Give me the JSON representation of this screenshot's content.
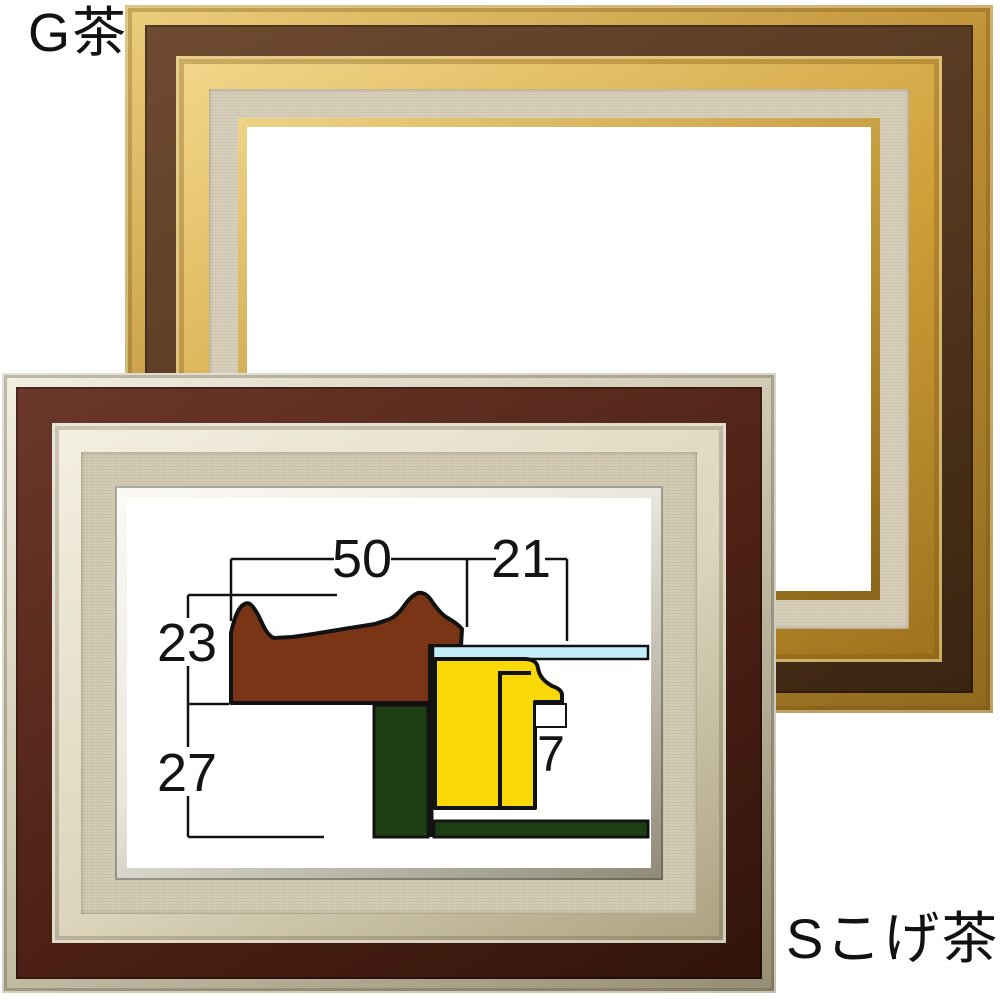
{
  "frames": {
    "gold": {
      "label": "G茶"
    },
    "silver": {
      "label": "Sこげ茶"
    }
  },
  "diagram": {
    "type": "frame-cross-section",
    "dimension_labels": {
      "molding_width": "50",
      "rabbet_width": "21",
      "molding_height": "23",
      "lower_depth": "27",
      "lip_depth": "7"
    }
  },
  "colors": {
    "gold-outer": "#bf9136",
    "gold-brown": "#54371f",
    "gold-mid": "#cf9f38",
    "gold-linen": "#d9d0bb",
    "gold-lip": "#c39a3b",
    "silver-outer": "#cfc8b1",
    "silver-brown": "#4e2115",
    "silver-mid": "#ddd5bd",
    "silver-linen": "#d5ccb5",
    "silver-lip": "#e9e7dd",
    "molding": "#7a3516",
    "liner": "#1d3d12",
    "canvas": "#f9d808",
    "glass": "#c4eef7",
    "outline": "#121212"
  }
}
